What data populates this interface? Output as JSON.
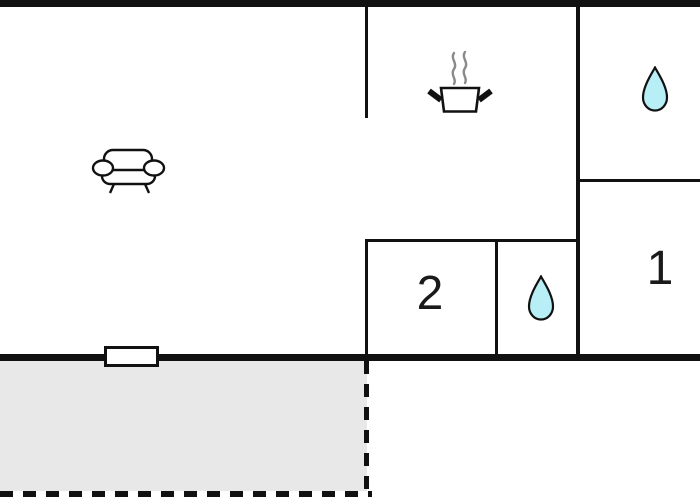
{
  "plan_type": "apartment-floor-plan",
  "colors": {
    "wall": "#111111",
    "room_fill": "#ffffff",
    "terrace_fill": "#e8e8e8",
    "water_drop": "#b8eef5",
    "steam": "#8a8a8a",
    "label_text": "#1a1a1a",
    "icon_line": "#111111"
  },
  "rooms": {
    "living_room": {
      "label": "",
      "icon": "sofa-icon"
    },
    "kitchen": {
      "label": "",
      "icon": "cooking-pot-icon"
    },
    "bathroom_top": {
      "label": "",
      "icon": "water-drop-icon"
    },
    "bedroom_1": {
      "label": "1",
      "icon": ""
    },
    "bedroom_2": {
      "label": "2",
      "icon": ""
    },
    "bathroom_small": {
      "label": "",
      "icon": "water-drop-icon"
    },
    "terrace": {
      "label": "",
      "icon": ""
    }
  }
}
